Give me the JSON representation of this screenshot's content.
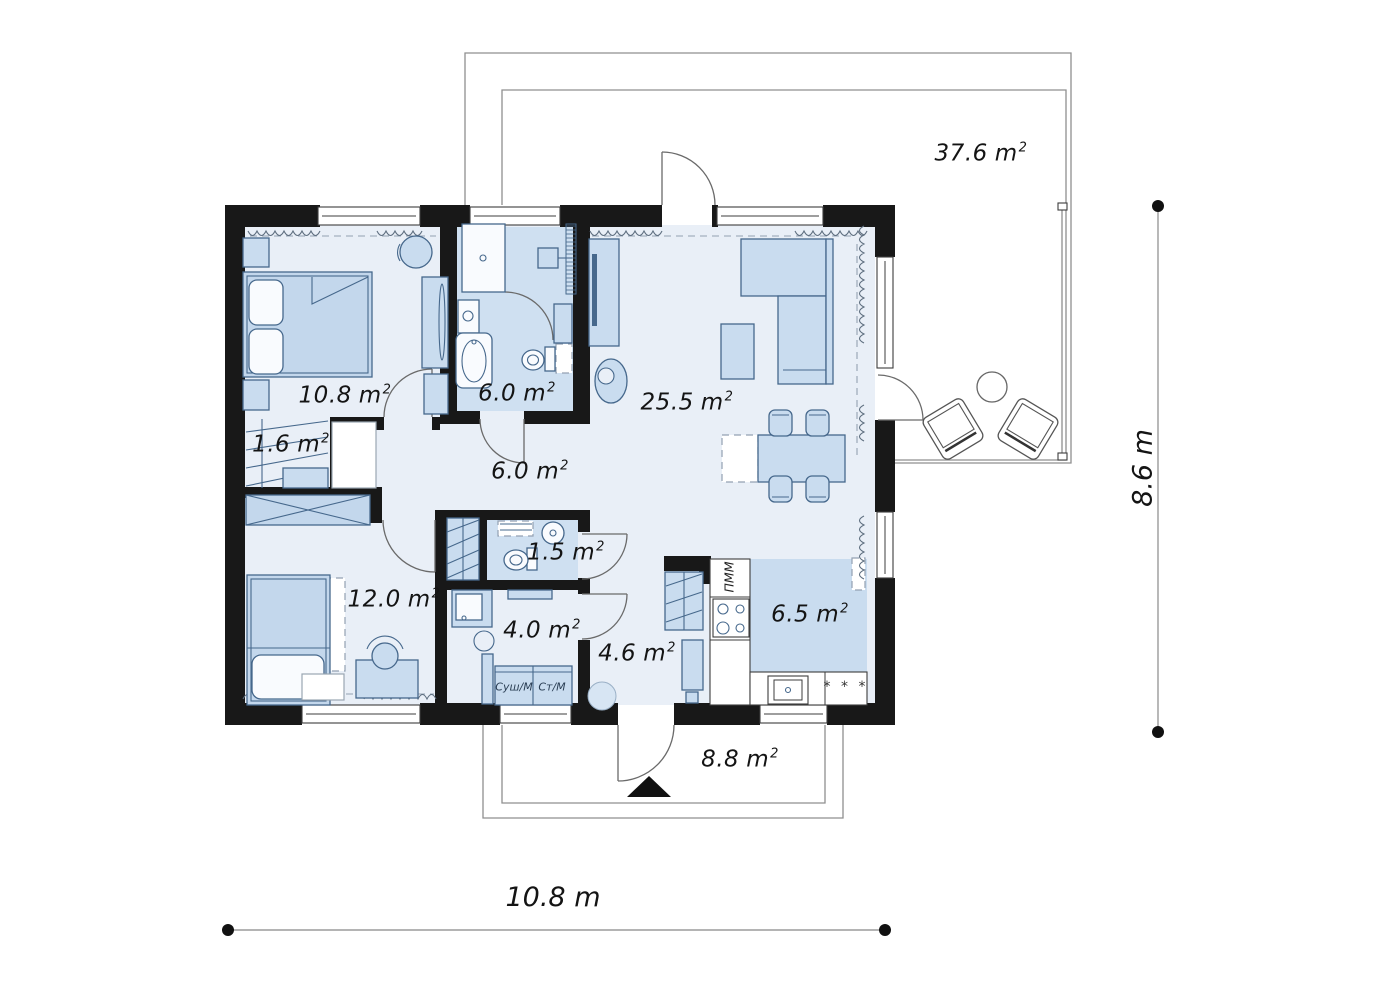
{
  "units": {
    "meter": "m",
    "square": "2"
  },
  "rooms": [
    {
      "name": "terrace",
      "area": "37.6"
    },
    {
      "name": "bedroom-1",
      "area": "10.8"
    },
    {
      "name": "bathroom",
      "area": "6.0"
    },
    {
      "name": "living-room",
      "area": "25.5"
    },
    {
      "name": "wardrobe",
      "area": "1.6"
    },
    {
      "name": "hall",
      "area": "6.0"
    },
    {
      "name": "wc",
      "area": "1.5"
    },
    {
      "name": "bedroom-2",
      "area": "12.0"
    },
    {
      "name": "utility-room",
      "area": "4.0"
    },
    {
      "name": "hallway",
      "area": "4.6"
    },
    {
      "name": "kitchen",
      "area": "6.5"
    },
    {
      "name": "porch",
      "area": "8.8"
    }
  ],
  "dimensions": {
    "width": {
      "label": "10.8 m"
    },
    "height": {
      "label": "8.6 m"
    }
  },
  "appliances": {
    "dryer": "Суш/М",
    "washer": "Ст/М",
    "dishwasher": "ПММ",
    "fridge_stars": "* * *"
  },
  "colors": {
    "wall": "#181818",
    "floor": "#e9eff7",
    "wet_floor": "#cfe0f1",
    "kitchen_floor": "#c9dcef",
    "furniture": "#c9dcef",
    "furniture_stroke": "#46688c"
  }
}
